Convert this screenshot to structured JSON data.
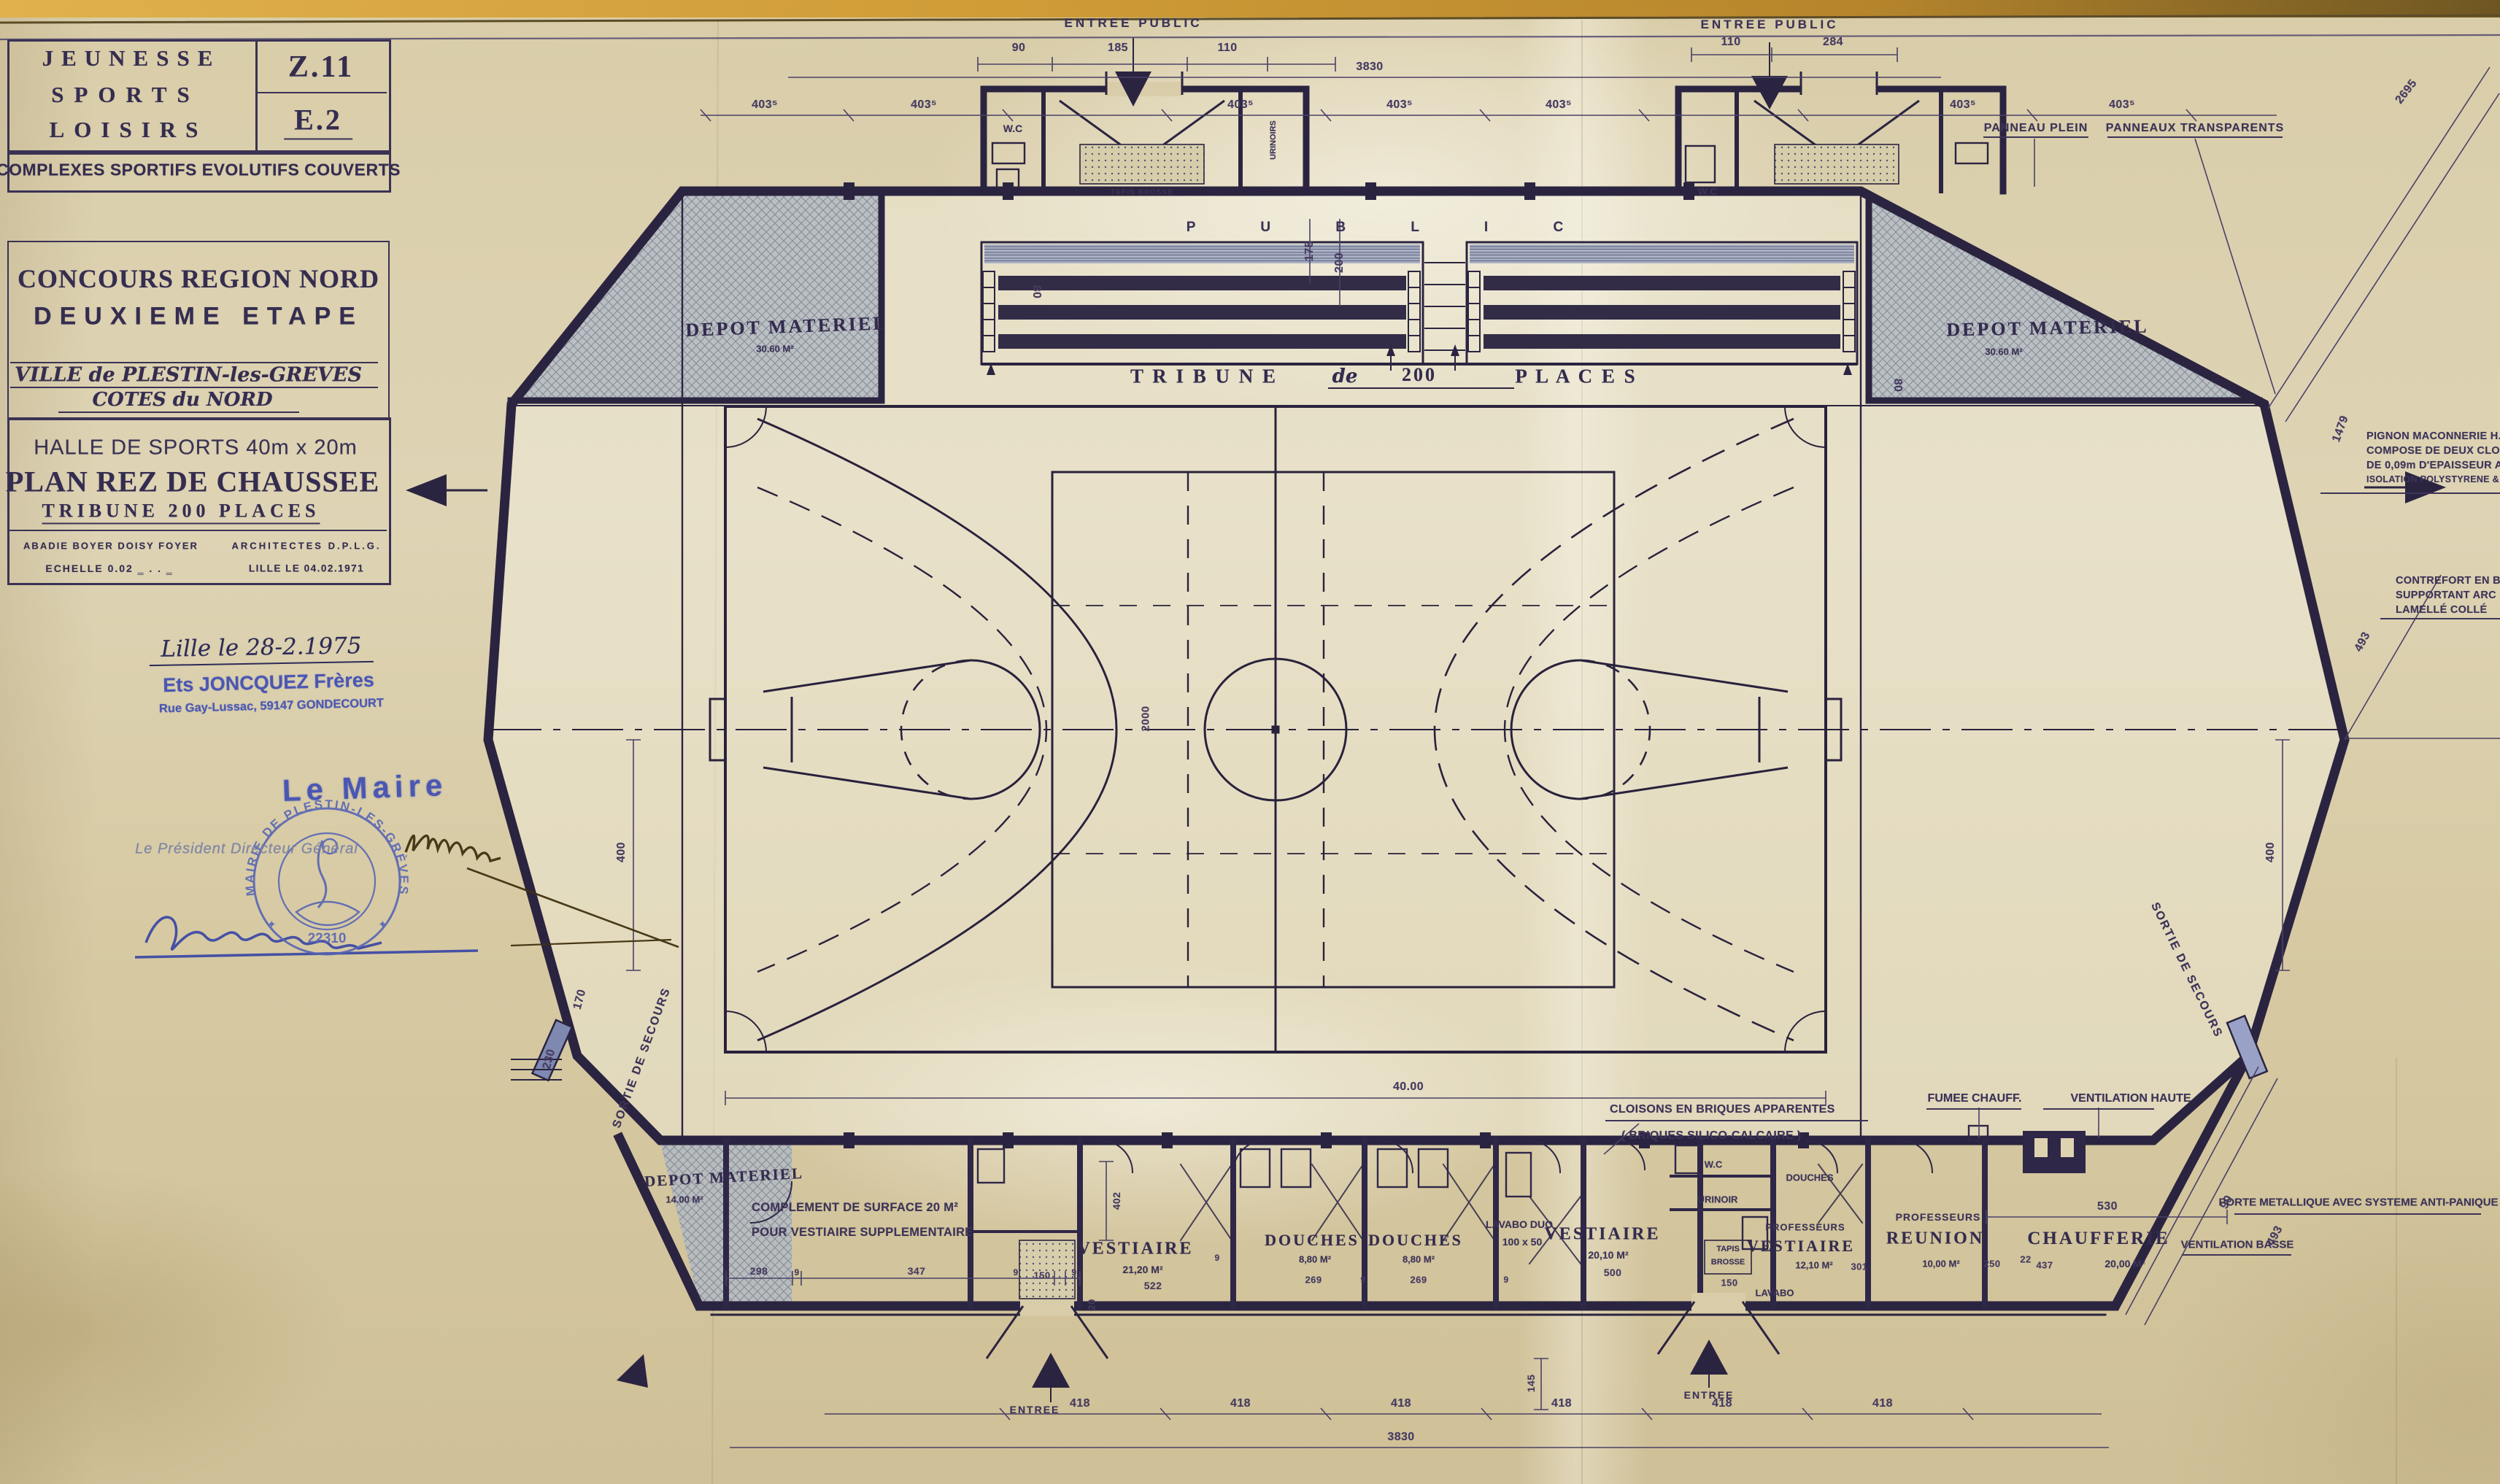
{
  "title_block": {
    "org": [
      "JEUNESSE",
      "SPORTS",
      "LOISIRS"
    ],
    "code_top": "Z.11",
    "code_bottom": "E.2",
    "program": "COMPLEXES SPORTIFS EVOLUTIFS COUVERTS",
    "contest": [
      "CONCOURS REGION NORD",
      "DEUXIEME ETAPE"
    ],
    "city": [
      "VILLE de PLESTIN-les-GREVES",
      "COTES du NORD"
    ],
    "project": [
      "HALLE DE SPORTS  40m x 20m",
      "PLAN REZ DE CHAUSSEE",
      "TRIBUNE  200  PLACES"
    ],
    "architects_names": "ABADIE   BOYER   DOISY   FOYER",
    "architects_title": "ARCHITECTES  D.P.L.G.",
    "scale": "ECHELLE  0.02  ‗ . . ‗",
    "date_place": "LILLE LE 04.02.1971"
  },
  "annotations": {
    "handwritten_date": "Lille le 28-2.1975",
    "company_stamp": [
      "Ets JONCQUEZ Frères",
      "Rue Gay-Lussac, 59147 GONDECOURT"
    ],
    "president_label": "Le Président Directeur Général",
    "mayor_label": "Le Maire",
    "round_stamp": {
      "text": "MAIRIE DE PLESTIN-LES-GRÈVES",
      "number": "22310"
    }
  },
  "plan": {
    "entrances": {
      "top": "ENTREE PUBLIC",
      "bottom": "ENTREE"
    },
    "depot": {
      "name": "DEPOT MATERIEL",
      "area_top": "30.60 M²",
      "area_bottom": "14.00 M²"
    },
    "tribune": {
      "public": "P U B L I C",
      "tribune": "T R I B U N E",
      "de": "de",
      "n": "200",
      "places": "P L A C E S",
      "row": "80"
    },
    "facade": {
      "plein": "PANNEAU PLEIN",
      "transparent": "PANNEAUX TRANSPARENTS"
    },
    "exits": {
      "label": "SORTIE DE SECOURS"
    },
    "small": {
      "wc": "W.C",
      "urinoirs": "URINOIRS",
      "urinoir": "URINOIR",
      "douches": "DOUCHES",
      "lavabo": "LAVABO",
      "tapis1": "TAPIS",
      "tapis2": "BROSSE",
      "tapis_full": "TAPIS BROSSE"
    },
    "rooms": {
      "complement": [
        "COMPLEMENT DE SURFACE  20 M²",
        "POUR VESTIAIRE SUPPLEMENTAIRE"
      ],
      "vestiaire": "VESTIAIRE",
      "vestiaire1_area": "21,20 M²",
      "douches": "DOUCHES",
      "douches_area": "8,80 M²",
      "lavabo_duo": "LAVABO DUO",
      "lavabo_duo_size": "100 x 50",
      "vestiaire2_area": "20,10 M²",
      "professeurs": "PROFESSEURS",
      "prof_vest_area": "12,10 M²",
      "reunion": "REUNION",
      "reunion_area": "10,00 M²",
      "chaufferie": "CHAUFFERIE",
      "chaufferie_area": "20,00 M²"
    },
    "notes": {
      "pignon": [
        "PIGNON MACONNERIE  H. 2,50m",
        "COMPOSE DE DEUX CLOISONS",
        "DE 0,09m D'EPAISSEUR AVEC",
        "ISOLATION POLYSTYRENE & POLIANE"
      ],
      "contrefort": [
        "CONTREFORT EN B.A.",
        "SUPPORTANT ARC EN",
        "LAMELLÉ COLLÉ"
      ],
      "cloisons": [
        "CLOISONS EN BRIQUES APPARENTES",
        "( BRIQUES SILICO-CALCAIRE )"
      ],
      "fumee": "FUMEE CHAUFF.",
      "vent_haute": "VENTILATION HAUTE",
      "vent_basse": "VENTILATION BASSE",
      "porte": "PORTE METALLIQUE AVEC SYSTEME ANTI-PANIQUE"
    },
    "dims": {
      "top_left": [
        "90",
        "185",
        "110"
      ],
      "top_right": [
        "110",
        "284"
      ],
      "total": "3830",
      "bay": "403⁵",
      "corner": "2695",
      "entry_depth": [
        "175",
        "200"
      ],
      "court_length": "40.00",
      "court_width": "2000",
      "side": "400",
      "d170": "170",
      "d230": "230",
      "diag_top": "1479",
      "diag_mid": "493",
      "diag_bot": "493",
      "door": "90",
      "bottom": "418",
      "d145": "145",
      "strip": [
        "298",
        "9",
        "347",
        "9",
        "150",
        "9"
      ],
      "d522": "522",
      "d269": "269",
      "d9": "9",
      "d402": "402",
      "d20": "20",
      "d500": "500",
      "d301": "301",
      "d250": "250",
      "d22": "22",
      "d437": "437",
      "d530": "530"
    }
  }
}
